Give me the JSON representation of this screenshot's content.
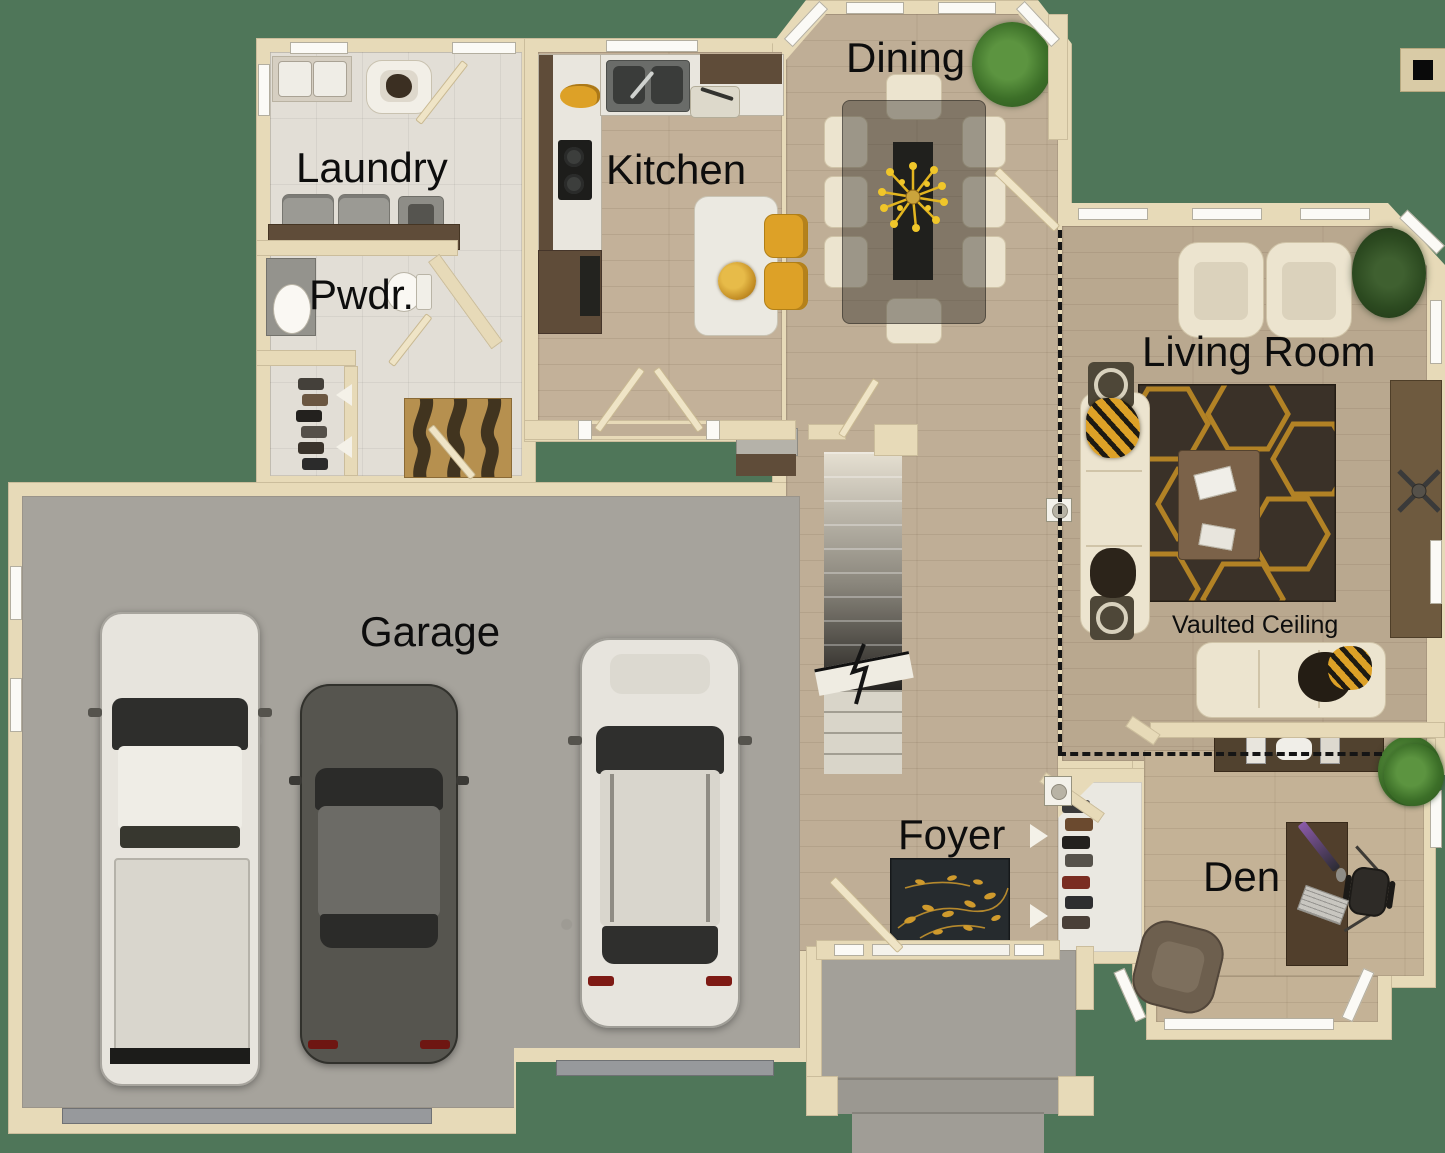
{
  "plan": {
    "labels": {
      "dining": "Dining",
      "laundry": "Laundry",
      "kitchen": "Kitchen",
      "powder": "Pwdr.",
      "living_room": "Living Room",
      "vaulted_ceiling": "Vaulted Ceiling",
      "garage": "Garage",
      "foyer": "Foyer",
      "den": "Den"
    }
  },
  "colors": {
    "background": "#4f7659",
    "wall": "#e7dab8",
    "wood_floor": "#bfae96",
    "wood_floor_kitchen": "#c3b199",
    "wood_floor_living": "#b9a88f",
    "wood_floor_den": "#c4b296",
    "tile_floor": "#e2ded6",
    "concrete_garage": "#a6a39c",
    "concrete_porch": "#a3a099",
    "cabinet_wood": "#5f4c39",
    "rug_dark_brown": "#3a3128",
    "rug_gold": "#bf8b25",
    "foyer_rug_dark": "#262b2e",
    "mud_rug_tan": "#b6904f",
    "accent_yellow": "#dda127",
    "sofa_cream": "#ece4cf",
    "car_white": "#e7e4dd",
    "car_gray": "#56554f",
    "stair_dark": "#23211e"
  }
}
